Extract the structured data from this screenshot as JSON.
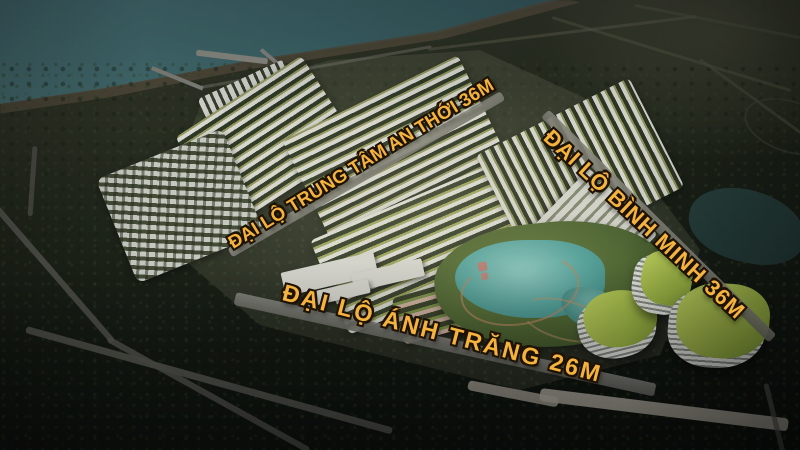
{
  "scene": {
    "description": "Aerial dusk 3D render of a coastal master-planned residential development with labeled avenues, lake park and green-roof hotel complex",
    "road_labels": [
      {
        "id": "trung-tam-an-thoi",
        "text": "ĐẠI LỘ TRUNG TÂM AN THỚI 36M"
      },
      {
        "id": "binh-minh",
        "text": "ĐẠI LỘ BÌNH MINH 36M"
      },
      {
        "id": "anh-trang",
        "text": "ĐẠI LỘ ÁNH TRĂNG 26M"
      }
    ],
    "colors": {
      "label_gold": "#F4B33E",
      "label_outline": "#1E1202",
      "sea": "#3E6A6B",
      "lake": "#57ACA3",
      "park_lawn": "#5C7838",
      "hotel_roof_green": "#B5CC4F",
      "forest_dark": "#141A11",
      "road_grey": "#8E8E82"
    }
  }
}
